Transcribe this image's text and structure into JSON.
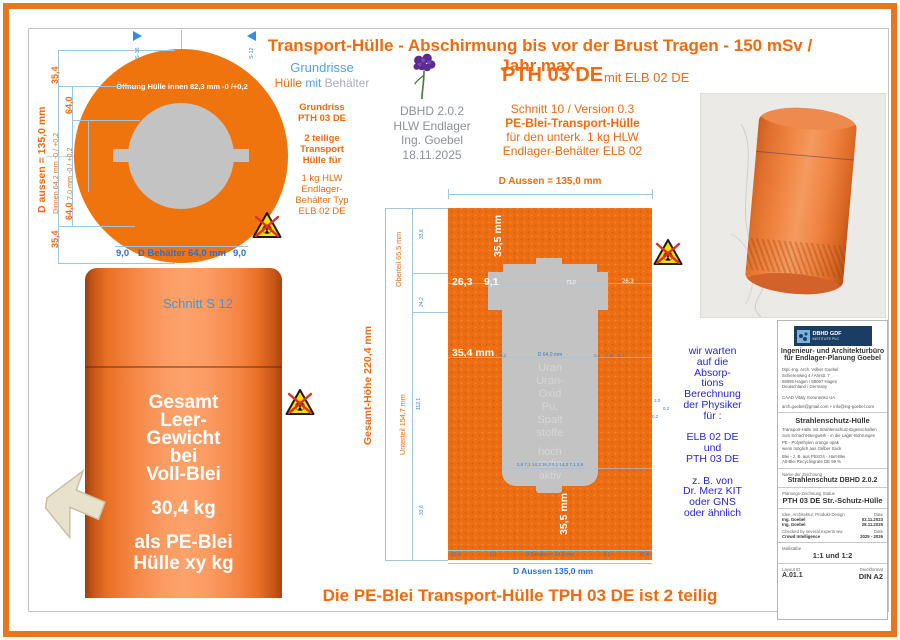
{
  "colors": {
    "accent_orange": "#F26A0D",
    "drawing_orange": "#F0740E",
    "dim_line_blue": "#9CC6E8",
    "label_blue": "#2B6FD4",
    "note_blue": "#2626D4",
    "fill_gray": "#C3C3C3",
    "logo_navy": "#1C3D63",
    "warning_yellow": "#FFD900"
  },
  "icons": {
    "radiation": "crossed-out radiation trefoil warning",
    "flower": "purple flower bouquet",
    "arrow": "beige 3d pointer arrow"
  },
  "header": {
    "title": "Transport-Hülle - Abschirmung bis vor der Brust Tragen - 150 mSv / Jahr max."
  },
  "footer": {
    "title": "Die PE-Blei Transport-Hülle TPH 03 DE ist 2 teilig"
  },
  "plan": {
    "flag_left": "S-16",
    "flag_right": "S-12",
    "opening": "Öffnung Hülle innen 82,3 mm -0 /+0,2",
    "d_aussen": "D aussen = 135,0 mm",
    "dim_35_top": "35,4",
    "dim_64_top": "64,0",
    "dim_dinnen": "Dinnen 64,2 mm -0 / +0,2",
    "dim_70": "7,0 mm -0 / +0,2",
    "dim_64_bot": "64,0",
    "dim_35_bot": "35,4",
    "b9_left": "9,0",
    "b_center": "D Behälter 64,0 mm",
    "b9_right": "9,0"
  },
  "legend": {
    "grundrisse": "Grundrisse",
    "huelle": "Hülle",
    "mit": "mit",
    "behaelter": "Behälter",
    "grundriss": "Grundriss",
    "pth": "PTH 03 DE",
    "teilige": "2 teilige\nTransport\nHülle für",
    "hlw": "1 kg HLW\nEndlager-\nBehälter Typ\nELB 02 DE"
  },
  "meta": {
    "lines": "DBHD 2.0.2\nHLW Endlager\nIng. Goebel\n18.11.2025"
  },
  "main_title": {
    "pth": "PTH 03 DE",
    "mit": "mit ELB 02 DE",
    "s1": "Schnitt 10 / Version 0.3",
    "s2": "PE-Blei-Transport-Hülle",
    "s3": "für den unterk. 1 kg HLW",
    "s4": "Endlager-Behälter ELB 02"
  },
  "section": {
    "d_aussen_top": "D Aussen = 135,0 mm",
    "t355": "35,5 mm",
    "d263": "26,3",
    "d91": "9,1",
    "d730": "73,0",
    "d263r": "26,3",
    "d354": "35,4 mm",
    "b355": "35,5 mm",
    "m01a": "0,1",
    "m64": "D 64,0 mm",
    "m01b": "0,1",
    "m09": "0,9",
    "m01c": "0,1",
    "row_inner": "2,9   7,1   14,3   15,3  0,1  14,3   7,1   2,9",
    "sb1": "35,4",
    "sb2": "0,1",
    "sb3": "D Behälter = 64,0 mm",
    "sb4": "0,1",
    "sb5": "35,4",
    "d_aussen_bottom": "D Aussen 135,0 mm",
    "oberteil": "Oberteil 65,5 mm",
    "unterteil": "Unterteil 154,7 mm",
    "gesamt": "Gesamt-Höhe  220,4 mm",
    "sm1": "33,6",
    "sm2": "24,2",
    "sm3": "112,1",
    "sm4": "33,6",
    "sm5": "3,0",
    "sm6": "0,2",
    "sm7": "0,2",
    "content": "Uran\nUran-\nOxid\nPu,\nSpalt\nstoffe",
    "content2": "hoch\nradio\naktiv"
  },
  "cylinder": {
    "schnitt": "Schnitt S 12",
    "weight": "Gesamt\nLeer-\nGewicht\nbei\nVoll-Blei",
    "kg": "30,4 kg",
    "pe": "als PE-Blei\nHülle xy kg"
  },
  "note": {
    "text": "wir warten\nauf die\nAbsorp-\ntions\nBerechnung\nder Physiker\nfür :\n\nELB 02 DE\nund\nPTH 03 DE\n\nz. B. von\nDr. Merz KIT\noder GNS\noder ähnlich"
  },
  "titleblock": {
    "logo1": "DBHD GDF",
    "logo2": "INSTITUTE PLC",
    "firm1": "Ingenieur- und Architekturbüro",
    "firm2": "für Endlager-Planung Goebel",
    "addr": "Dipl.-Ing. Arch. Volker Goebel\nSchierenweg 4 / Ahrstr. 7\n58095 Hagen / 58097 Hagen\nDeutschland / Germany",
    "caad": "CAAD Vitaly Gorunenko UA",
    "mail": "arch.goebel@gmail.com + info@ing-goebel.com",
    "h1": "Strahlenschutz-Hülle",
    "p1": "Transport-Hülle mit Strahlenschutz-Eigenschaften\nzum Schacht-Bergwerk - in die Lager-Bohrungen",
    "p2": "PE - Polyethylen orange opak\nwenn möglich aus Gelber Sack",
    "p3": "Blei - z. B. aus PbSO4 - Hart-Blei\nAlt-Blei Recyclingrate DE 99 %",
    "name_label": "Name der Zeichnung",
    "name": "Strahlenschutz DBHD 2.0.2",
    "status_label": "Planungs-Zeichnung Status",
    "status": "PTH 03 DE Str.-Schutz-Hülle",
    "r1l": "Idee, Architektur, Produkt-Design",
    "r1r": "Date",
    "r2l": "Ing. Goebel",
    "r2r": "03.11.2023",
    "r3l": "Ing. Goebel",
    "r3r": "28.11.2025",
    "r4l": "Checked by several experts ww",
    "r4r": "Date",
    "r5l": "Crowd Intelligence",
    "r5r": "2025 - 2026",
    "scale_label": "Maßstäbe",
    "scale": "1:1 und 1:2",
    "layout_label": "Layout ID",
    "layout": "A.01.1",
    "format_label": "Druckformat",
    "format": "DIN A2"
  }
}
